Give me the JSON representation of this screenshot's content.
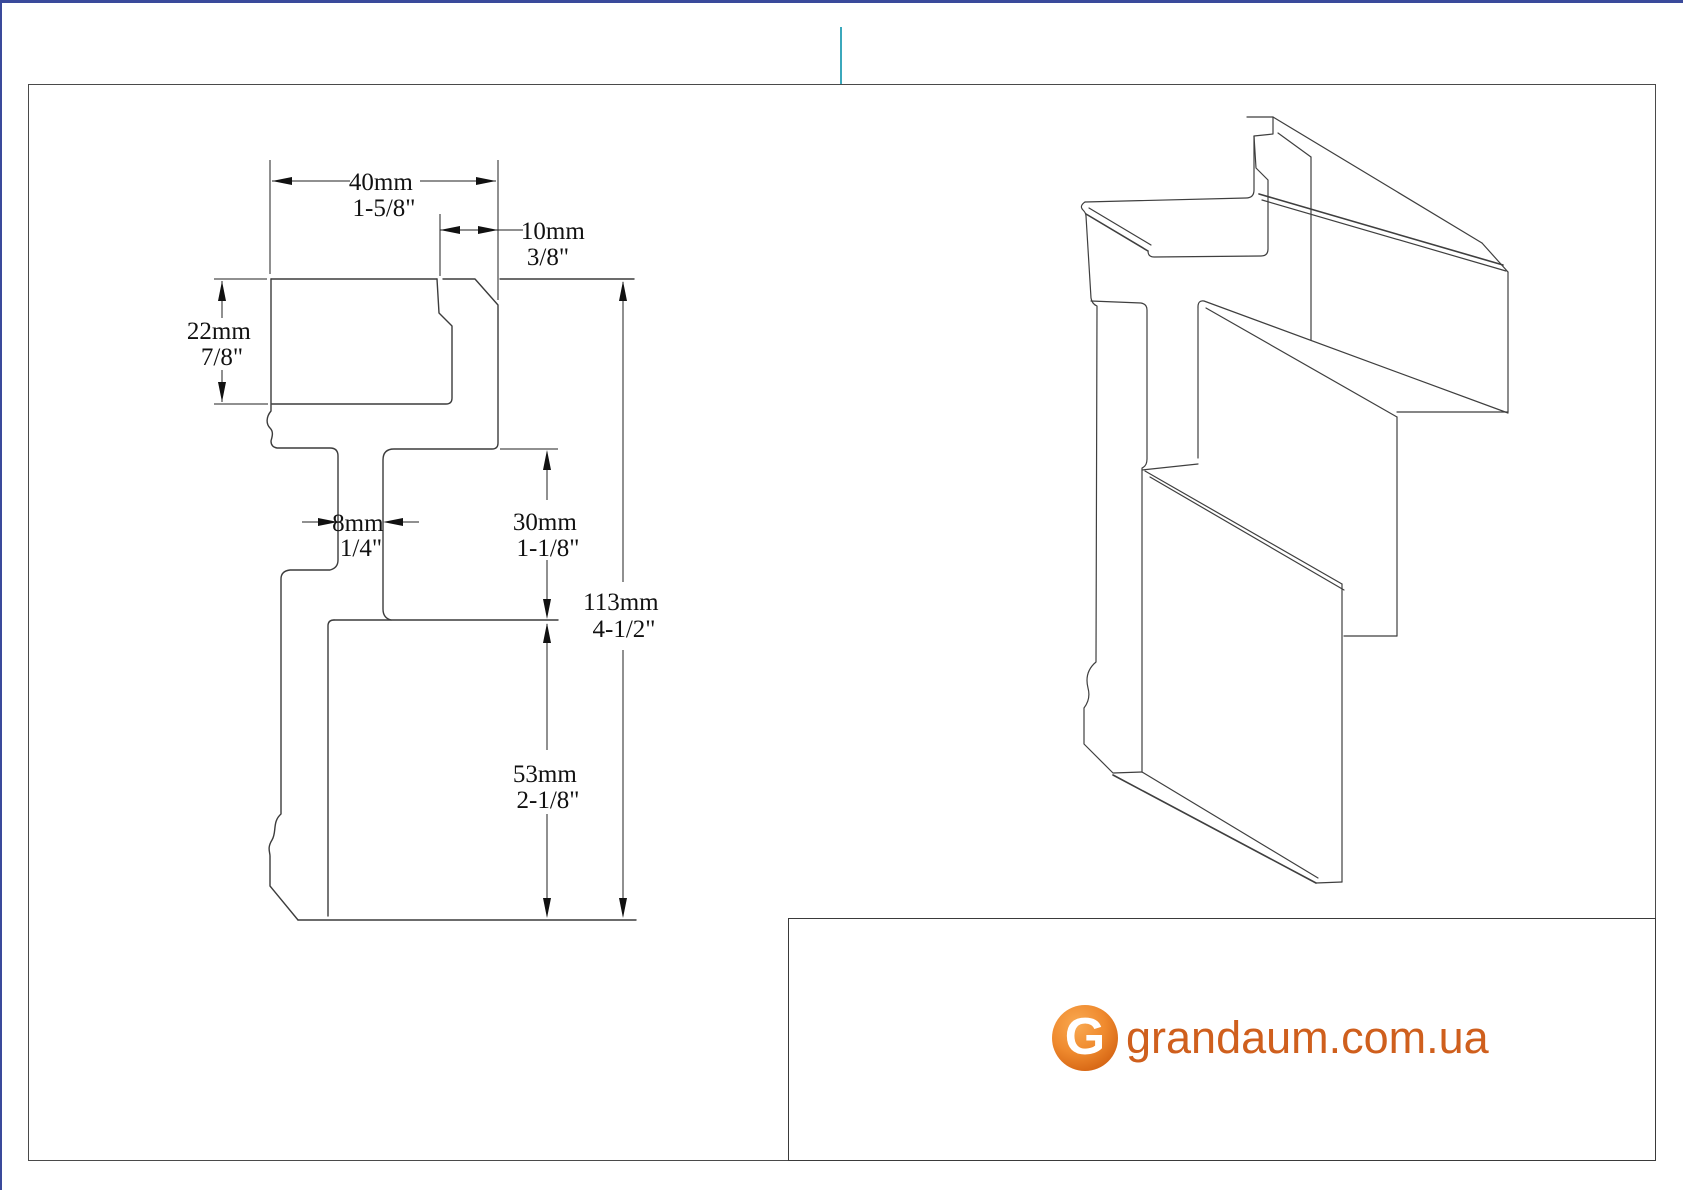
{
  "page": {
    "top_border_color": "#3a4a9b",
    "left_border_color": "#3a4a9b",
    "cursor_line_color": "#3ba8bc",
    "frame_color": "#4a4a4a"
  },
  "drawing": {
    "line_color": "#3c3c3c",
    "dimensions": {
      "width": {
        "mm": "40mm",
        "inch": "1-5/8\""
      },
      "notch": {
        "mm": "10mm",
        "inch": "3/8\""
      },
      "top_height": {
        "mm": "22mm",
        "inch": "7/8\""
      },
      "stem": {
        "mm": "8mm",
        "inch": "1/4\""
      },
      "middle_height": {
        "mm": "30mm",
        "inch": "1-1/8\""
      },
      "total_height": {
        "mm": "113mm",
        "inch": "4-1/2\""
      },
      "bottom_height": {
        "mm": "53mm",
        "inch": "2-1/8\""
      }
    }
  },
  "footer": {
    "logo_letter": "G",
    "website": "grandaum.com.ua",
    "accent": "#d4671c"
  }
}
